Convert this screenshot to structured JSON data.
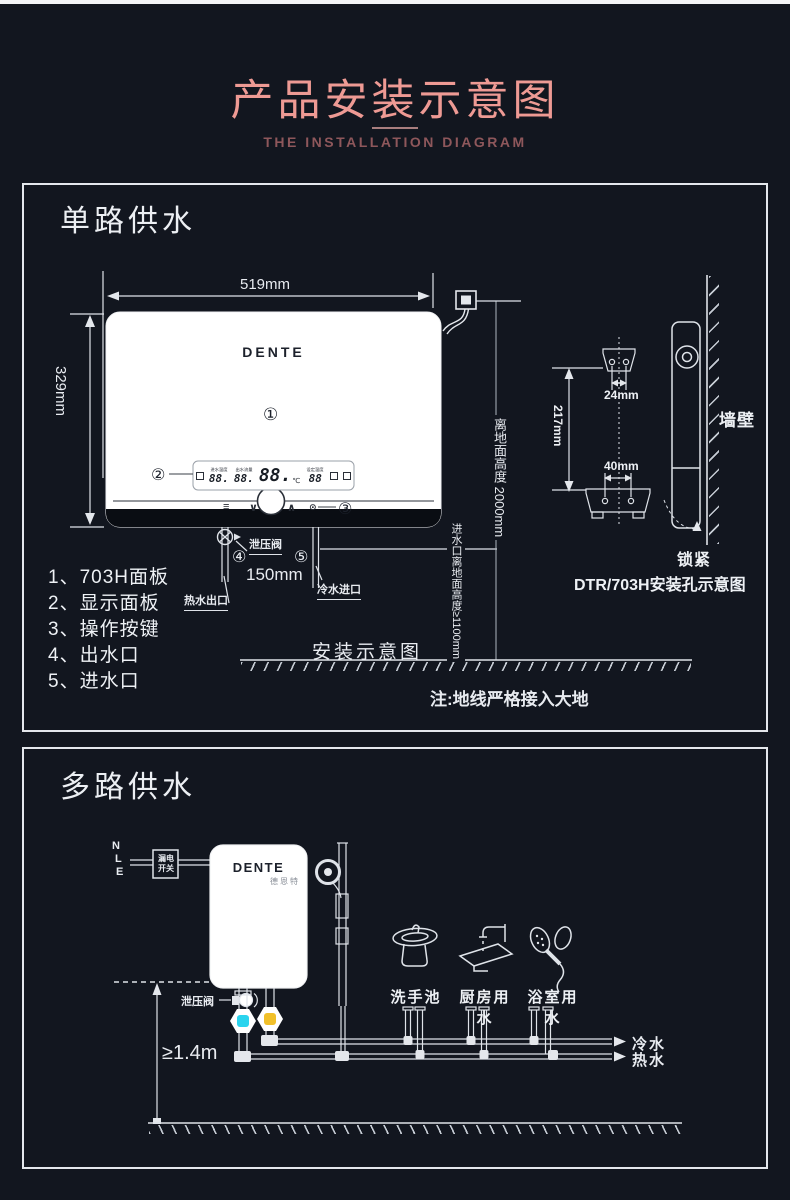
{
  "page": {
    "title": "产品安装示意图",
    "subtitle": "THE INSTALLATION DIAGRAM"
  },
  "colors": {
    "background": "#12161f",
    "accent_pink": "#ee9a94",
    "subtitle_pink": "#8e575b",
    "line_white": "#e4e7ec",
    "cold_valve_core": "#2bd4ee",
    "hot_valve_core": "#f1c02a"
  },
  "single": {
    "heading": "单路供水",
    "brand": "DENTE",
    "dim_width": "519mm",
    "dim_height": "329mm",
    "dim_gap": "150mm",
    "markers": {
      "m1": "①",
      "m2": "②",
      "m3": "③",
      "m4": "④",
      "m5": "⑤"
    },
    "display": {
      "seg1_label": "进水温度",
      "seg1": "88.",
      "seg2_label": "出水流量",
      "seg2": "88.",
      "seg3": "88.",
      "seg3_unit": "℃",
      "seg4_label": "设定温度",
      "seg4": "88"
    },
    "buttons": {
      "menu": "≡",
      "down": "∨",
      "up": "∧",
      "power": "⊙"
    },
    "relief_valve": "泄压阀",
    "hot_outlet": "热水出口",
    "cold_inlet": "冷水进口",
    "wall_height": "离地面高度 2000mm",
    "inlet_height": "进水口离地面高度≥1100mm",
    "caption": "安装示意图",
    "ground_note": "注:地线严格接入大地",
    "legend": [
      "1、703H面板",
      "2、显示面板",
      "3、操作按键",
      "4、出水口",
      "5、进水口"
    ],
    "mount": {
      "hole_gap_top": "24mm",
      "hole_gap_vertical": "217mm",
      "hole_gap_bottom": "40mm",
      "wall": "墙壁",
      "lock": "锁紧",
      "caption": "DTR/703H安装孔示意图"
    }
  },
  "multi": {
    "heading": "多路供水",
    "brand": "DENTE",
    "brand_cn": "德恩特",
    "wire_n": "N",
    "wire_l": "L",
    "wire_e": "E",
    "breaker_line1": "漏电",
    "breaker_line2": "开关",
    "relief_valve": "泄压阀",
    "min_height": "≥1.4m",
    "fixtures": [
      "洗手池",
      "厨房用水",
      "浴室用水"
    ],
    "cold_label": "冷水",
    "hot_label": "热水"
  }
}
